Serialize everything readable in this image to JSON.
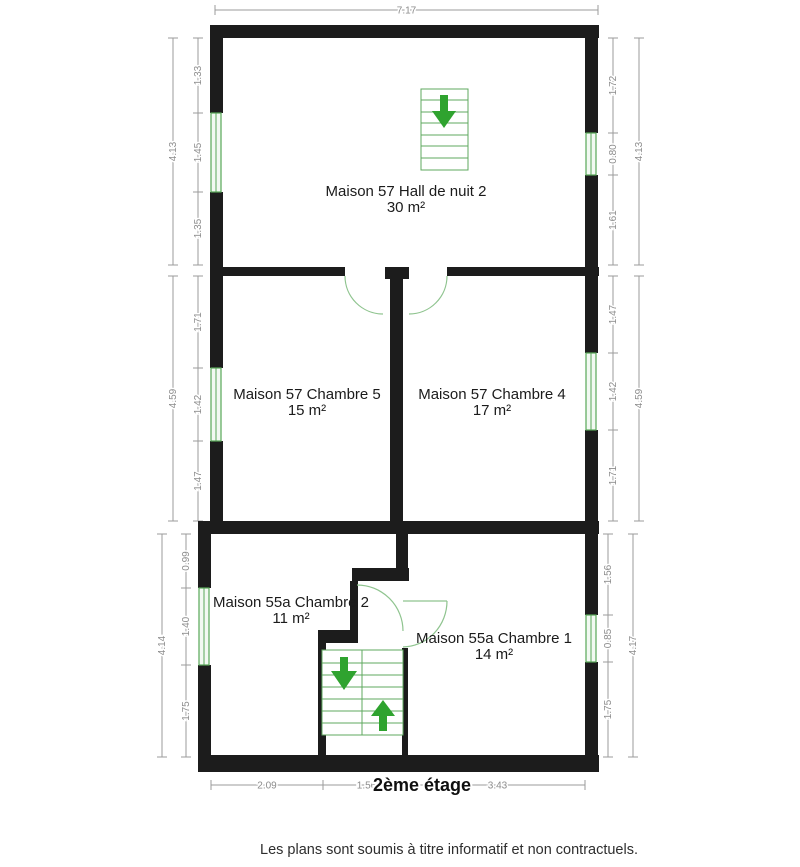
{
  "plan": {
    "title": "2ème étage",
    "footer": "Les plans sont soumis à titre informatif et non contractuels.",
    "rooms": [
      {
        "name": "Maison 57 Hall de nuit 2",
        "area": "30 m²"
      },
      {
        "name": "Maison 57 Chambre 5",
        "area": "15 m²"
      },
      {
        "name": "Maison 57 Chambre 4",
        "area": "17 m²"
      },
      {
        "name": "Maison 55a Chambre 2",
        "area": "11 m²"
      },
      {
        "name": "Maison 55a Chambre 1",
        "area": "14 m²"
      }
    ],
    "dimensions": {
      "top": "7.17",
      "bottom": [
        "2.09",
        "1.56",
        "3.43"
      ],
      "left_top": {
        "outer": "4.13",
        "segments": [
          "1.33",
          "1.45",
          "1.35"
        ]
      },
      "right_top": {
        "outer": "4.13",
        "segments": [
          "1.72",
          "0.80",
          "1.61"
        ]
      },
      "left_mid": {
        "outer": "4.59",
        "segments": [
          "1.71",
          "1.42",
          "1.47"
        ]
      },
      "right_mid": {
        "outer": "4.59",
        "segments": [
          "1.47",
          "1.42",
          "1.71"
        ]
      },
      "left_bot": {
        "outer": "4.14",
        "segments": [
          "0.99",
          "1.40",
          "1.75"
        ]
      },
      "right_bot": {
        "outer": "4.17",
        "segments": [
          "1.56",
          "0.85",
          "1.75"
        ]
      }
    },
    "colors": {
      "wall": "#1c1c1c",
      "stair_green": "#5fa95f",
      "arrow_green": "#2fa32f",
      "door_green": "#8fc48f",
      "window_green": "#58a758",
      "window_fill": "#f2f9f2",
      "dim_line": "#9b9b9b",
      "dim_text": "#8c8c8c"
    }
  }
}
